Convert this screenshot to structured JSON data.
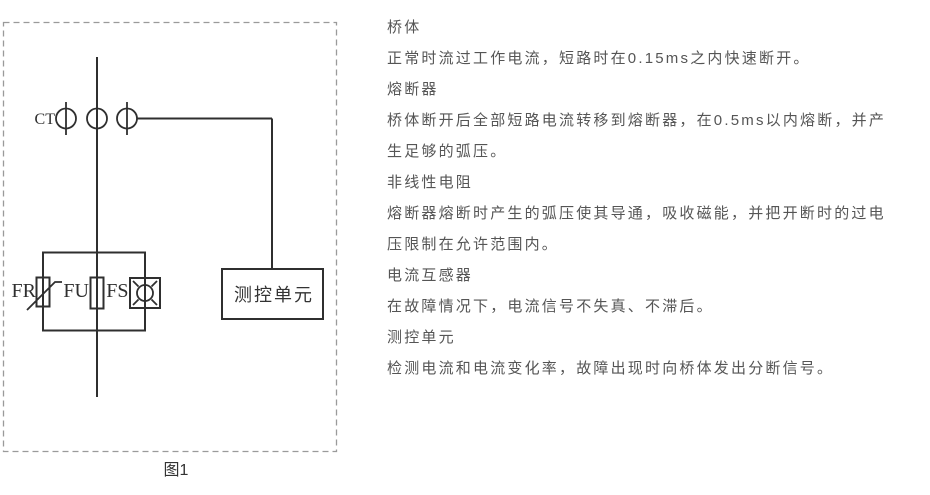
{
  "figure": {
    "caption": "图1",
    "ct_label": "CT",
    "fr_label": "FR",
    "fu_label": "FU",
    "fs_label": "FS",
    "control_unit_label": "测控单元"
  },
  "panel": {
    "lines": [
      "桥体",
      "正常时流过工作电流，短路时在0.15ms之内快速断开。",
      "熔断器",
      "桥体断开后全部短路电流转移到熔断器，在0.5ms以内熔断，并产",
      "生足够的弧压。",
      "非线性电阻",
      "熔断器熔断时产生的弧压使其导通，吸收磁能，并把开断时的过电",
      "压限制在允许范围内。",
      "电流互感器",
      "在故障情况下，电流信号不失真、不滞后。",
      "测控单元",
      "检测电流和电流变化率，故障出现时向桥体发出分断信号。"
    ]
  },
  "colors": {
    "diagram_line": "#2f2f2f",
    "dashed_border": "#9a9a9a",
    "body_text": "#555555",
    "background": "#ffffff"
  }
}
